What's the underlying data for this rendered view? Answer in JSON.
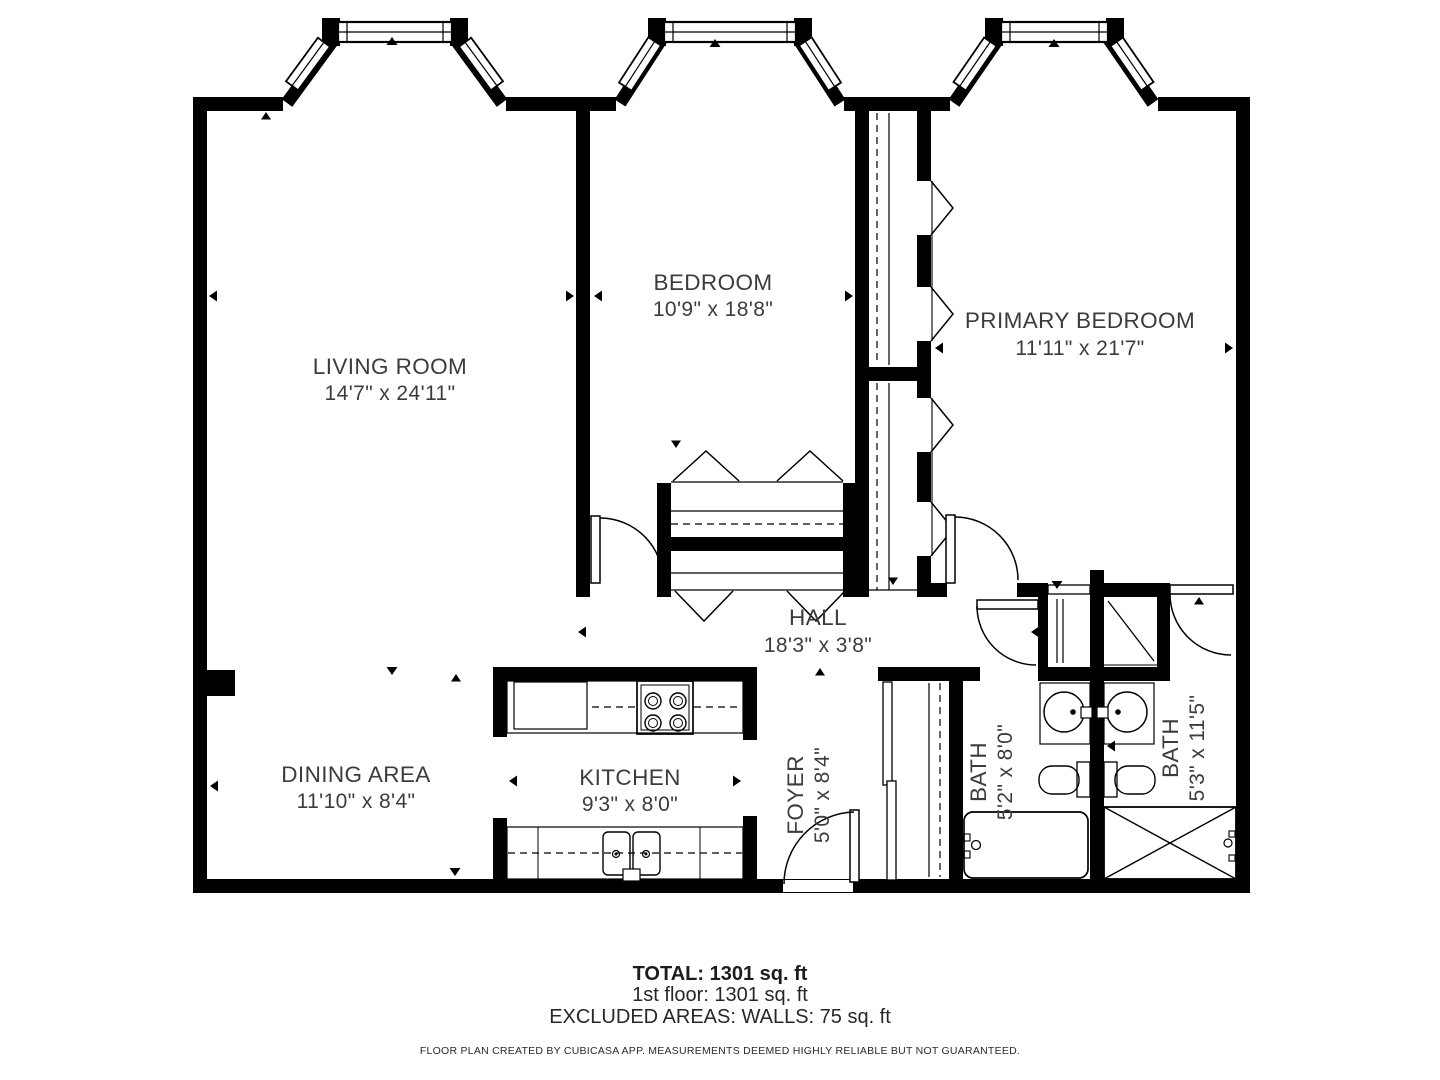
{
  "plan": {
    "rooms": {
      "living": {
        "name": "LIVING ROOM",
        "dims": "14'7\" x 24'11\""
      },
      "bedroom": {
        "name": "BEDROOM",
        "dims": "10'9\" x 18'8\""
      },
      "primary": {
        "name": "PRIMARY BEDROOM",
        "dims": "11'11\" x 21'7\""
      },
      "hall": {
        "name": "HALL",
        "dims": "18'3\" x 3'8\""
      },
      "dining": {
        "name": "DINING AREA",
        "dims": "11'10\" x 8'4\""
      },
      "kitchen": {
        "name": "KITCHEN",
        "dims": "9'3\" x 8'0\""
      },
      "foyer": {
        "name": "FOYER",
        "dims": "5'0\" x 8'4\""
      },
      "bath1": {
        "name": "BATH",
        "dims": "5'2\" x 8'0\""
      },
      "bath2": {
        "name": "BATH",
        "dims": "5'3\" x 11'5\""
      }
    },
    "fixtures": [
      "stove-icon",
      "refrigerator-icon",
      "kitchen-sink-icon",
      "washbasin-icon",
      "toilet-icon",
      "bathtub-icon",
      "shower-icon",
      "closet-rod",
      "bay-window",
      "door-arc"
    ],
    "summary": {
      "total": "TOTAL: 1301 sq. ft",
      "floor1": "1st floor: 1301 sq. ft",
      "excluded": "EXCLUDED AREAS: WALLS: 75 sq. ft"
    },
    "disclaimer": "FLOOR PLAN CREATED BY CUBICASA APP. MEASUREMENTS DEEMED HIGHLY RELIABLE BUT NOT GUARANTEED.",
    "colors": {
      "wall": "#000000",
      "label": "#3c3c3c",
      "background": "#ffffff"
    }
  }
}
